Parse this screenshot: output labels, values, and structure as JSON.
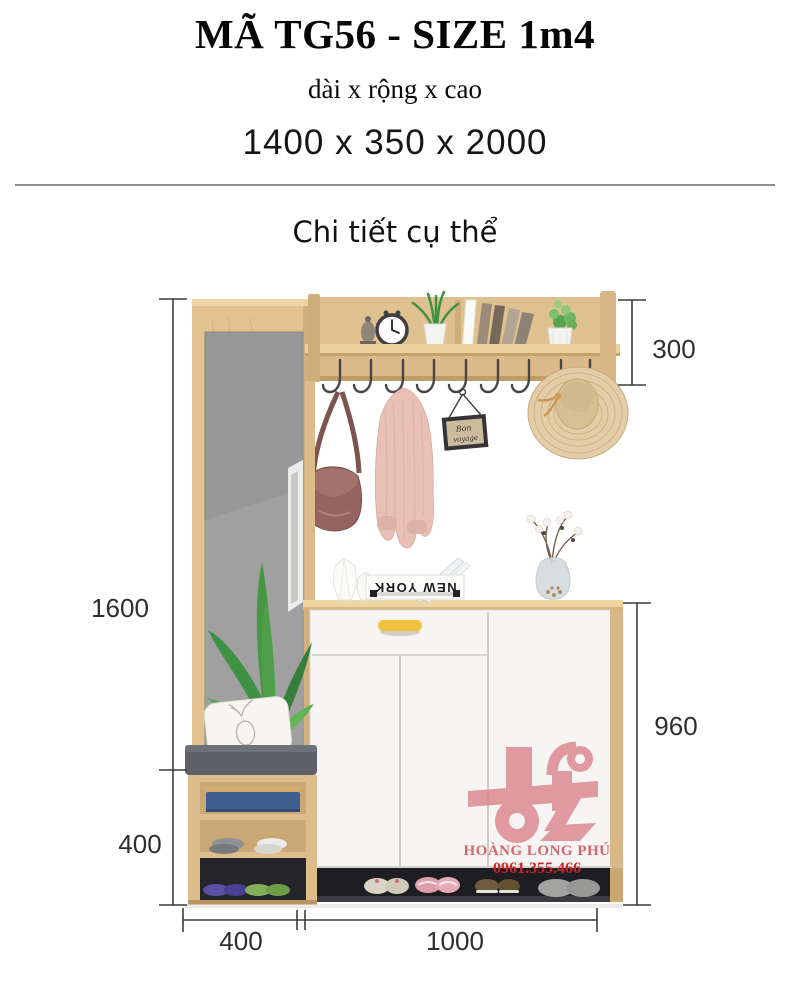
{
  "header": {
    "title": "MÃ TG56 - SIZE 1m4",
    "caption": "dài x rộng x cao",
    "size": "1400 x 350 x 2000"
  },
  "section": {
    "title": "Chi tiết cụ thể"
  },
  "dims": {
    "shelf_height": "300",
    "column_height": "1600",
    "bench_height": "400",
    "cabinet_height": "960",
    "bench_width": "400",
    "cabinet_width": "1000"
  },
  "decor": {
    "book_title": "NEW YORK",
    "sign_line1": "Bon",
    "sign_line2": "voyage"
  },
  "watermark": {
    "name": "HOÀNG LONG PHÚ",
    "phone": "0961.355.466"
  },
  "colors": {
    "wood": "#e2c28f",
    "mirror_gray": "#979797",
    "cabinet_white": "#f6f5f3",
    "accent_handle": "#f2c340",
    "cushion_gray": "#5d6167",
    "watermark_pink": "#db868d",
    "watermark_text": "#d4646d",
    "phone_red": "#c5262e"
  }
}
